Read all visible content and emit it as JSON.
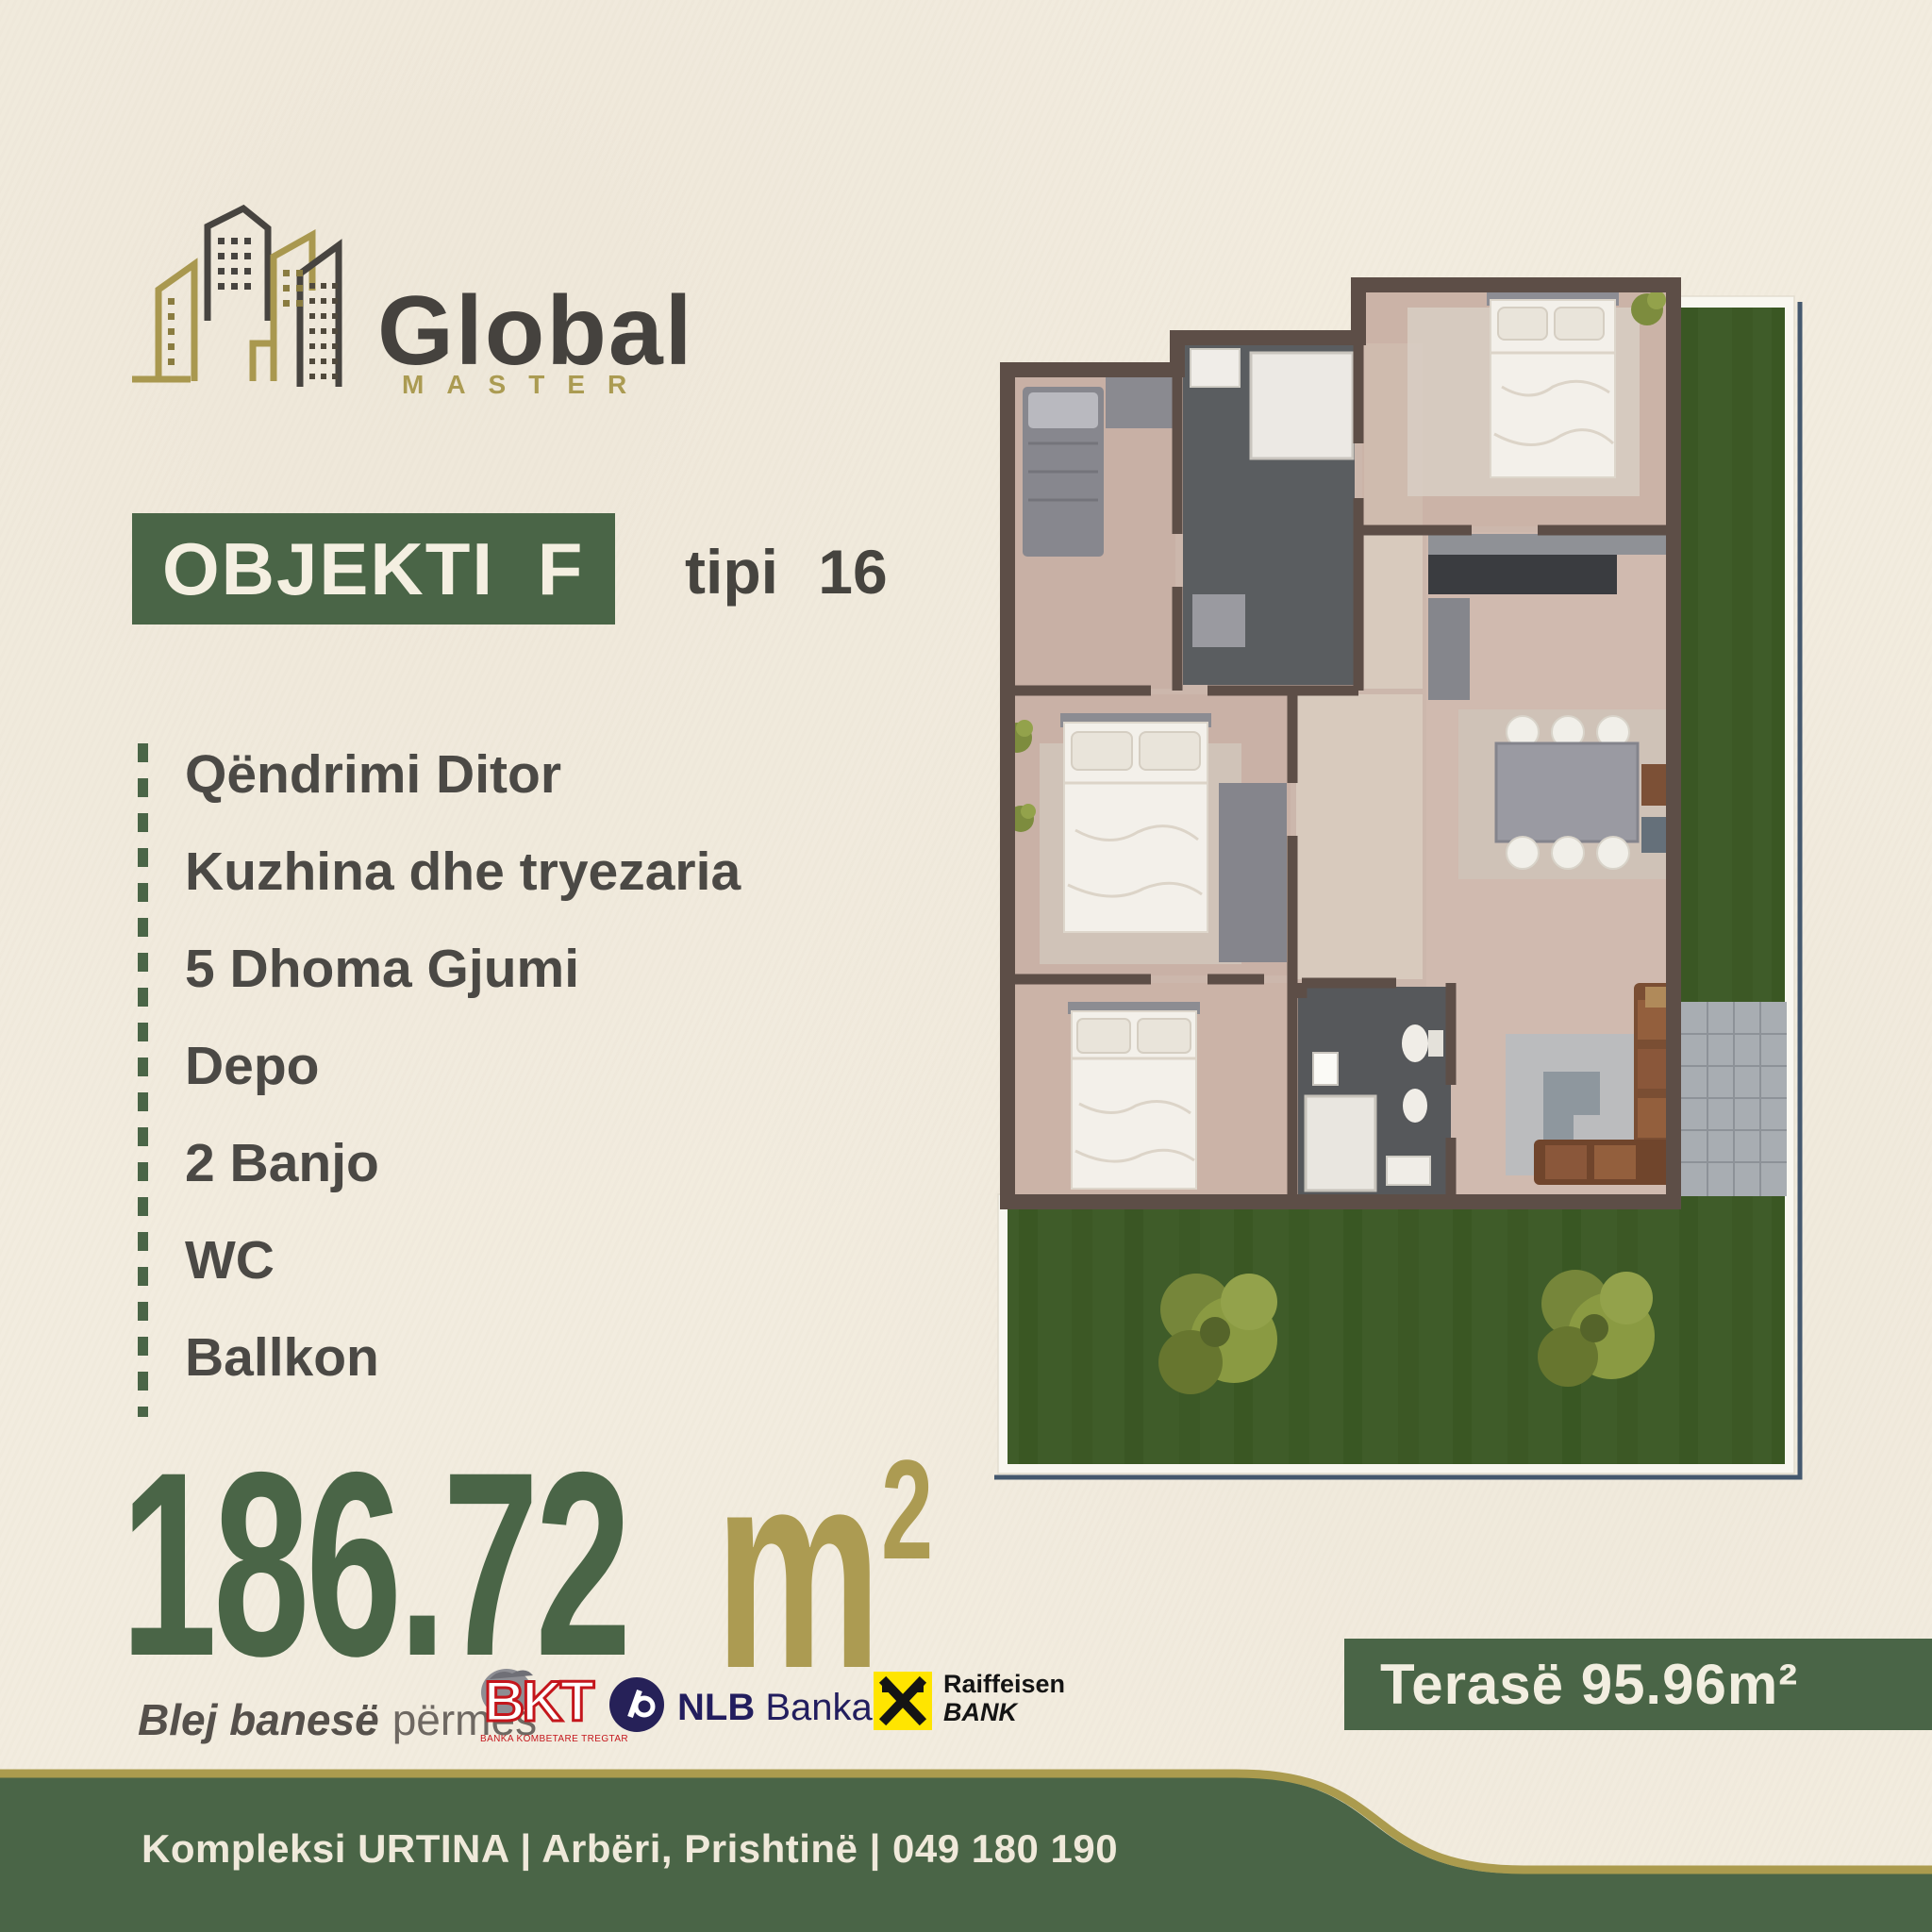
{
  "brand": {
    "name": "Global",
    "tagline": "MASTER"
  },
  "headline": {
    "object_label": "OBJEKTI F",
    "type_label": "tipi 16"
  },
  "features": [
    "Qëndrimi Ditor",
    "Kuzhina dhe tryezaria",
    "5 Dhoma Gjumi",
    "Depo",
    "2 Banjo",
    "WC",
    "Ballkon"
  ],
  "area": {
    "number": "186.72",
    "unit": "m",
    "exponent": "2"
  },
  "financing": {
    "lead_bold": "Blej banesë",
    "lead_rest": "përmes",
    "banks": [
      {
        "name": "BKT",
        "subtitle": "BANKA KOMBETARE TREGTARE"
      },
      {
        "label_bold": "NLB",
        "label_rest": " Banka"
      },
      {
        "label_top": "Raiffeisen",
        "label_bottom": "BANK"
      }
    ]
  },
  "terrace": {
    "label": "Terasë 95.96m²"
  },
  "footer": {
    "text": "Kompleksi URTINA | Arbëri, Prishtinë | 049 180 190"
  },
  "colors": {
    "background": "#f2ecdf",
    "green": "#4a6547",
    "gold": "#ab9b52",
    "text_dark": "#46443f",
    "grass": "#3f5c29",
    "wall_brown": "#5d4e47",
    "wood_floor": "#ccb7ac",
    "bkt_red": "#c4161c",
    "nlb_blue": "#262158",
    "raiffeisen_yellow": "#ffe500"
  }
}
